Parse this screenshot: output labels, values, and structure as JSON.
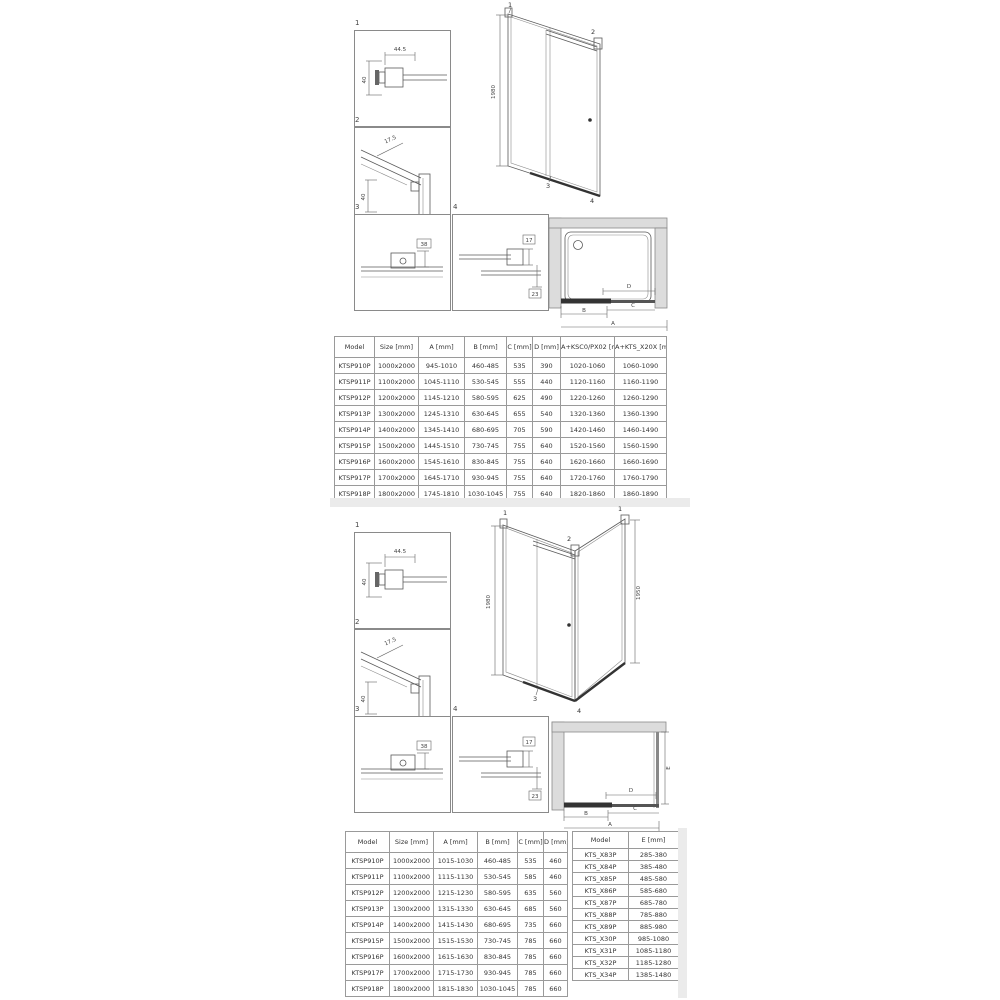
{
  "colors": {
    "line": "#5a5a5a",
    "wall_fill": "#dcdcdc",
    "table_border": "#9a9a9a",
    "accent_dark": "#333333"
  },
  "section1": {
    "details": {
      "d1": {
        "num": "1",
        "dim_width": "44.5",
        "dim_height": "40"
      },
      "d2": {
        "num": "2",
        "dim_diag": "17.5",
        "dim_height": "40"
      },
      "d3": {
        "num": "3",
        "dim": "38"
      },
      "d4": {
        "num": "4",
        "dim_top": "17",
        "dim_bottom": "23"
      }
    },
    "elevation": {
      "height": "1980",
      "c1": "1",
      "c2": "2",
      "c3": "3",
      "c4": "4"
    },
    "plan": {
      "a": "A",
      "b": "B",
      "c": "C",
      "d": "D"
    },
    "table": {
      "headers": [
        "Model",
        "Size [mm]",
        "A [mm]",
        "B [mm]",
        "C [mm]",
        "D [mm]",
        "A+KSC0/PX02 [mm]",
        "A+KTS_X20X [mm]"
      ],
      "rows": [
        [
          "KTSP910P",
          "1000x2000",
          "945-1010",
          "460-485",
          "535",
          "390",
          "1020-1060",
          "1060-1090"
        ],
        [
          "KTSP911P",
          "1100x2000",
          "1045-1110",
          "530-545",
          "555",
          "440",
          "1120-1160",
          "1160-1190"
        ],
        [
          "KTSP912P",
          "1200x2000",
          "1145-1210",
          "580-595",
          "625",
          "490",
          "1220-1260",
          "1260-1290"
        ],
        [
          "KTSP913P",
          "1300x2000",
          "1245-1310",
          "630-645",
          "655",
          "540",
          "1320-1360",
          "1360-1390"
        ],
        [
          "KTSP914P",
          "1400x2000",
          "1345-1410",
          "680-695",
          "705",
          "590",
          "1420-1460",
          "1460-1490"
        ],
        [
          "KTSP915P",
          "1500x2000",
          "1445-1510",
          "730-745",
          "755",
          "640",
          "1520-1560",
          "1560-1590"
        ],
        [
          "KTSP916P",
          "1600x2000",
          "1545-1610",
          "830-845",
          "755",
          "640",
          "1620-1660",
          "1660-1690"
        ],
        [
          "KTSP917P",
          "1700x2000",
          "1645-1710",
          "930-945",
          "755",
          "640",
          "1720-1760",
          "1760-1790"
        ],
        [
          "KTSP918P",
          "1800x2000",
          "1745-1810",
          "1030-1045",
          "755",
          "640",
          "1820-1860",
          "1860-1890"
        ]
      ]
    }
  },
  "section2": {
    "details": {
      "d1": {
        "num": "1",
        "dim_width": "44.5",
        "dim_height": "40"
      },
      "d2": {
        "num": "2",
        "dim_diag": "17.5",
        "dim_height": "40"
      },
      "d3": {
        "num": "3",
        "dim": "38"
      },
      "d4": {
        "num": "4",
        "dim_top": "17",
        "dim_bottom": "23"
      }
    },
    "elevation": {
      "height_left": "1980",
      "height_right": "1950",
      "c1": "1",
      "c2": "2",
      "c3": "3",
      "c4": "4"
    },
    "plan": {
      "a": "A",
      "b": "B",
      "c": "C",
      "d": "D",
      "e": "E"
    },
    "door_table": {
      "headers": [
        "Model",
        "Size [mm]",
        "A [mm]",
        "B [mm]",
        "C [mm]",
        "D [mm]"
      ],
      "rows": [
        [
          "KTSP910P",
          "1000x2000",
          "1015-1030",
          "460-485",
          "535",
          "460"
        ],
        [
          "KTSP911P",
          "1100x2000",
          "1115-1130",
          "530-545",
          "585",
          "460"
        ],
        [
          "KTSP912P",
          "1200x2000",
          "1215-1230",
          "580-595",
          "635",
          "560"
        ],
        [
          "KTSP913P",
          "1300x2000",
          "1315-1330",
          "630-645",
          "685",
          "560"
        ],
        [
          "KTSP914P",
          "1400x2000",
          "1415-1430",
          "680-695",
          "735",
          "660"
        ],
        [
          "KTSP915P",
          "1500x2000",
          "1515-1530",
          "730-745",
          "785",
          "660"
        ],
        [
          "KTSP916P",
          "1600x2000",
          "1615-1630",
          "830-845",
          "785",
          "660"
        ],
        [
          "KTSP917P",
          "1700x2000",
          "1715-1730",
          "930-945",
          "785",
          "660"
        ],
        [
          "KTSP918P",
          "1800x2000",
          "1815-1830",
          "1030-1045",
          "785",
          "660"
        ]
      ]
    },
    "wall_table": {
      "headers": [
        "Model",
        "E [mm]"
      ],
      "rows": [
        [
          "KTS_X83P",
          "285-380"
        ],
        [
          "KTS_X84P",
          "385-480"
        ],
        [
          "KTS_X85P",
          "485-580"
        ],
        [
          "KTS_X86P",
          "585-680"
        ],
        [
          "KTS_X87P",
          "685-780"
        ],
        [
          "KTS_X88P",
          "785-880"
        ],
        [
          "KTS_X89P",
          "885-980"
        ],
        [
          "KTS_X30P",
          "985-1080"
        ],
        [
          "KTS_X31P",
          "1085-1180"
        ],
        [
          "KTS_X32P",
          "1185-1280"
        ],
        [
          "KTS_X34P",
          "1385-1480"
        ]
      ]
    }
  }
}
